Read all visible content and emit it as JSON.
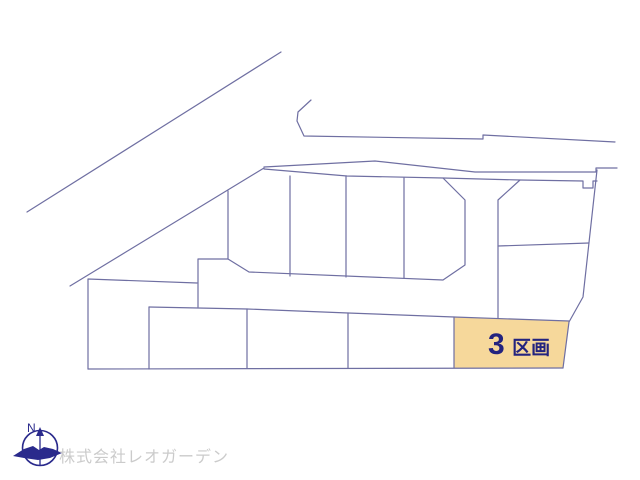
{
  "page": {
    "background": "#ffffff"
  },
  "map": {
    "line_color": "#6f6fa2",
    "highlight": {
      "label_full": "3区画",
      "label_number": "3",
      "label_suffix": "区画",
      "fill": "#f6d89b",
      "label_color": "#23237f"
    }
  },
  "compass": {
    "north_label": "N",
    "color": "#2a2a8c"
  },
  "footer": {
    "company_name": "株式会社レオガーデン",
    "text_color": "#cbcbcb"
  }
}
